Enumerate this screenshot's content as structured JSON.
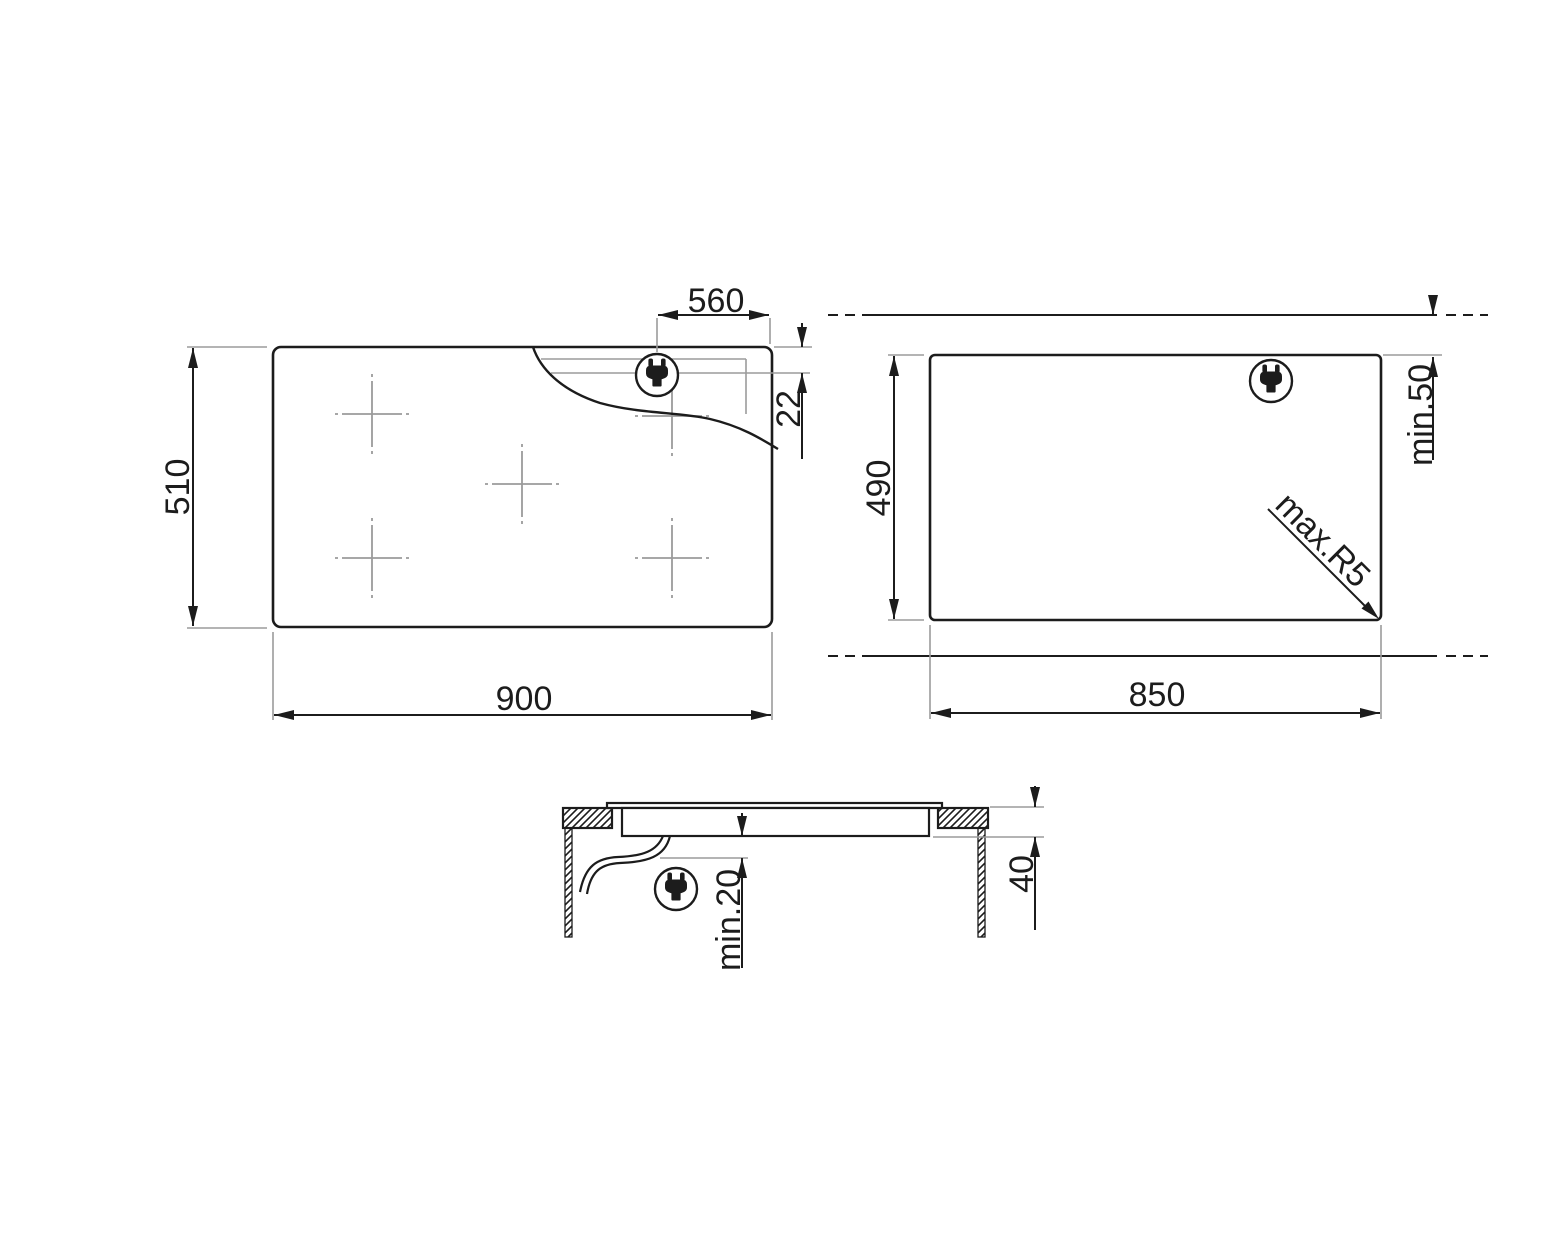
{
  "top_view": {
    "width": "900",
    "height": "510",
    "cable_offset_x": "560",
    "cable_offset_y": "22"
  },
  "cutout_view": {
    "width": "850",
    "height": "490",
    "rear_clearance": "min.50",
    "corner_radius": "max.R5"
  },
  "section_view": {
    "recess_depth": "40",
    "bottom_clearance": "min.20"
  },
  "icons": {
    "plug": "power-plug-icon"
  },
  "style": {
    "line_color": "#1c1c1c",
    "secondary_line_color": "#9b9b9b",
    "background": "#ffffff"
  }
}
